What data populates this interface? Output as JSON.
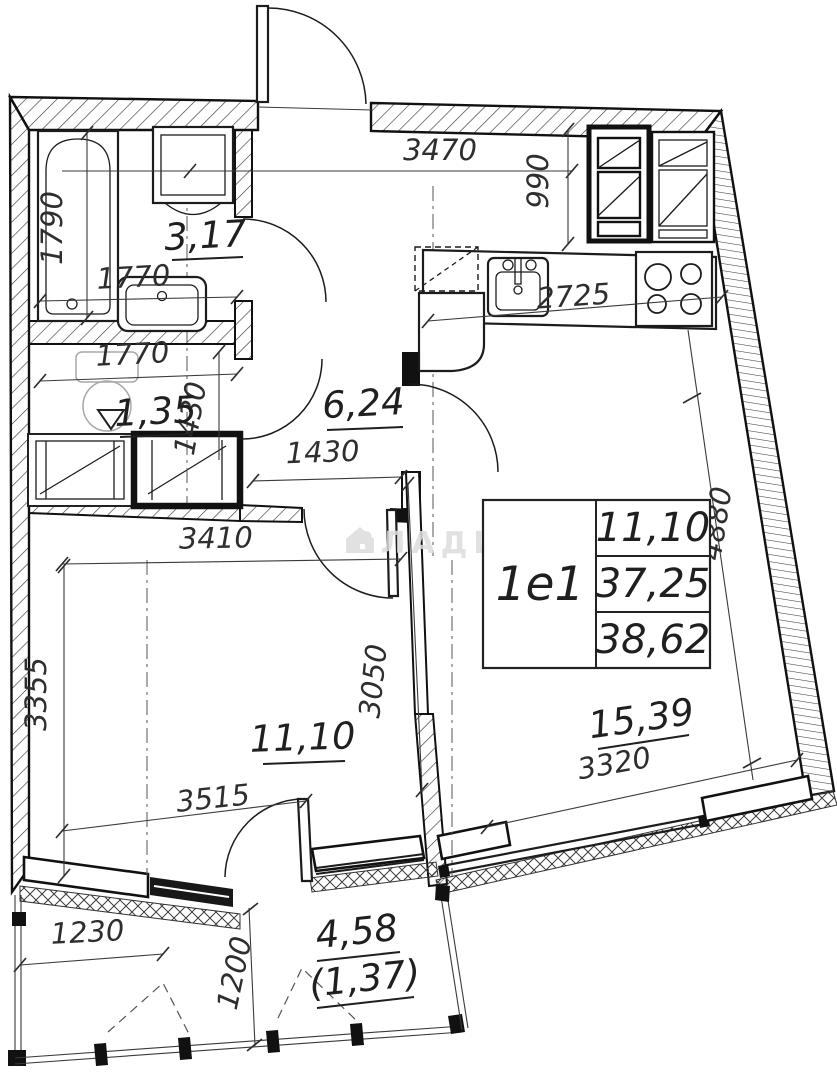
{
  "plan": {
    "type": "apartment floor plan",
    "unit": {
      "code": "1е1"
    },
    "info_table": {
      "living_area": "11,10",
      "apartment_area": "37,25",
      "total_area": "38,62"
    },
    "rooms": {
      "bathroom": "3,17",
      "wc": "1,35",
      "hallway": "6,24",
      "bedroom": "11,10",
      "living_kitchen": "15,39",
      "balcony": "4,58",
      "balcony_reduced": "(1,37)"
    },
    "watermark": "ВЛАДИС"
  },
  "labels": {
    "dim_3470": "3470",
    "dim_990": "990",
    "dim_2725": "2725",
    "dim_1790": "1790",
    "dim_1770_bath": "1770",
    "dim_1770_wc": "1770",
    "dim_1430_wc": "1430",
    "dim_1430_hall": "1430",
    "dim_3410": "3410",
    "dim_3355": "3355",
    "dim_3050": "3050",
    "dim_3515": "3515",
    "dim_3320": "3320",
    "dim_4880": "4880",
    "dim_1230": "1230",
    "dim_1200": "1200",
    "area_bathroom": "3,17",
    "area_wc": "1,35",
    "area_hall": "6,24",
    "area_bedroom": "11,10",
    "area_living": "15,39",
    "area_balcony": "4,58",
    "area_balcony_paren": "(1,37)",
    "unit": "1е1",
    "info_row1": "11,10",
    "info_row2": "37,25",
    "info_row3": "38,62",
    "watermark": "ВЛАДИС"
  }
}
